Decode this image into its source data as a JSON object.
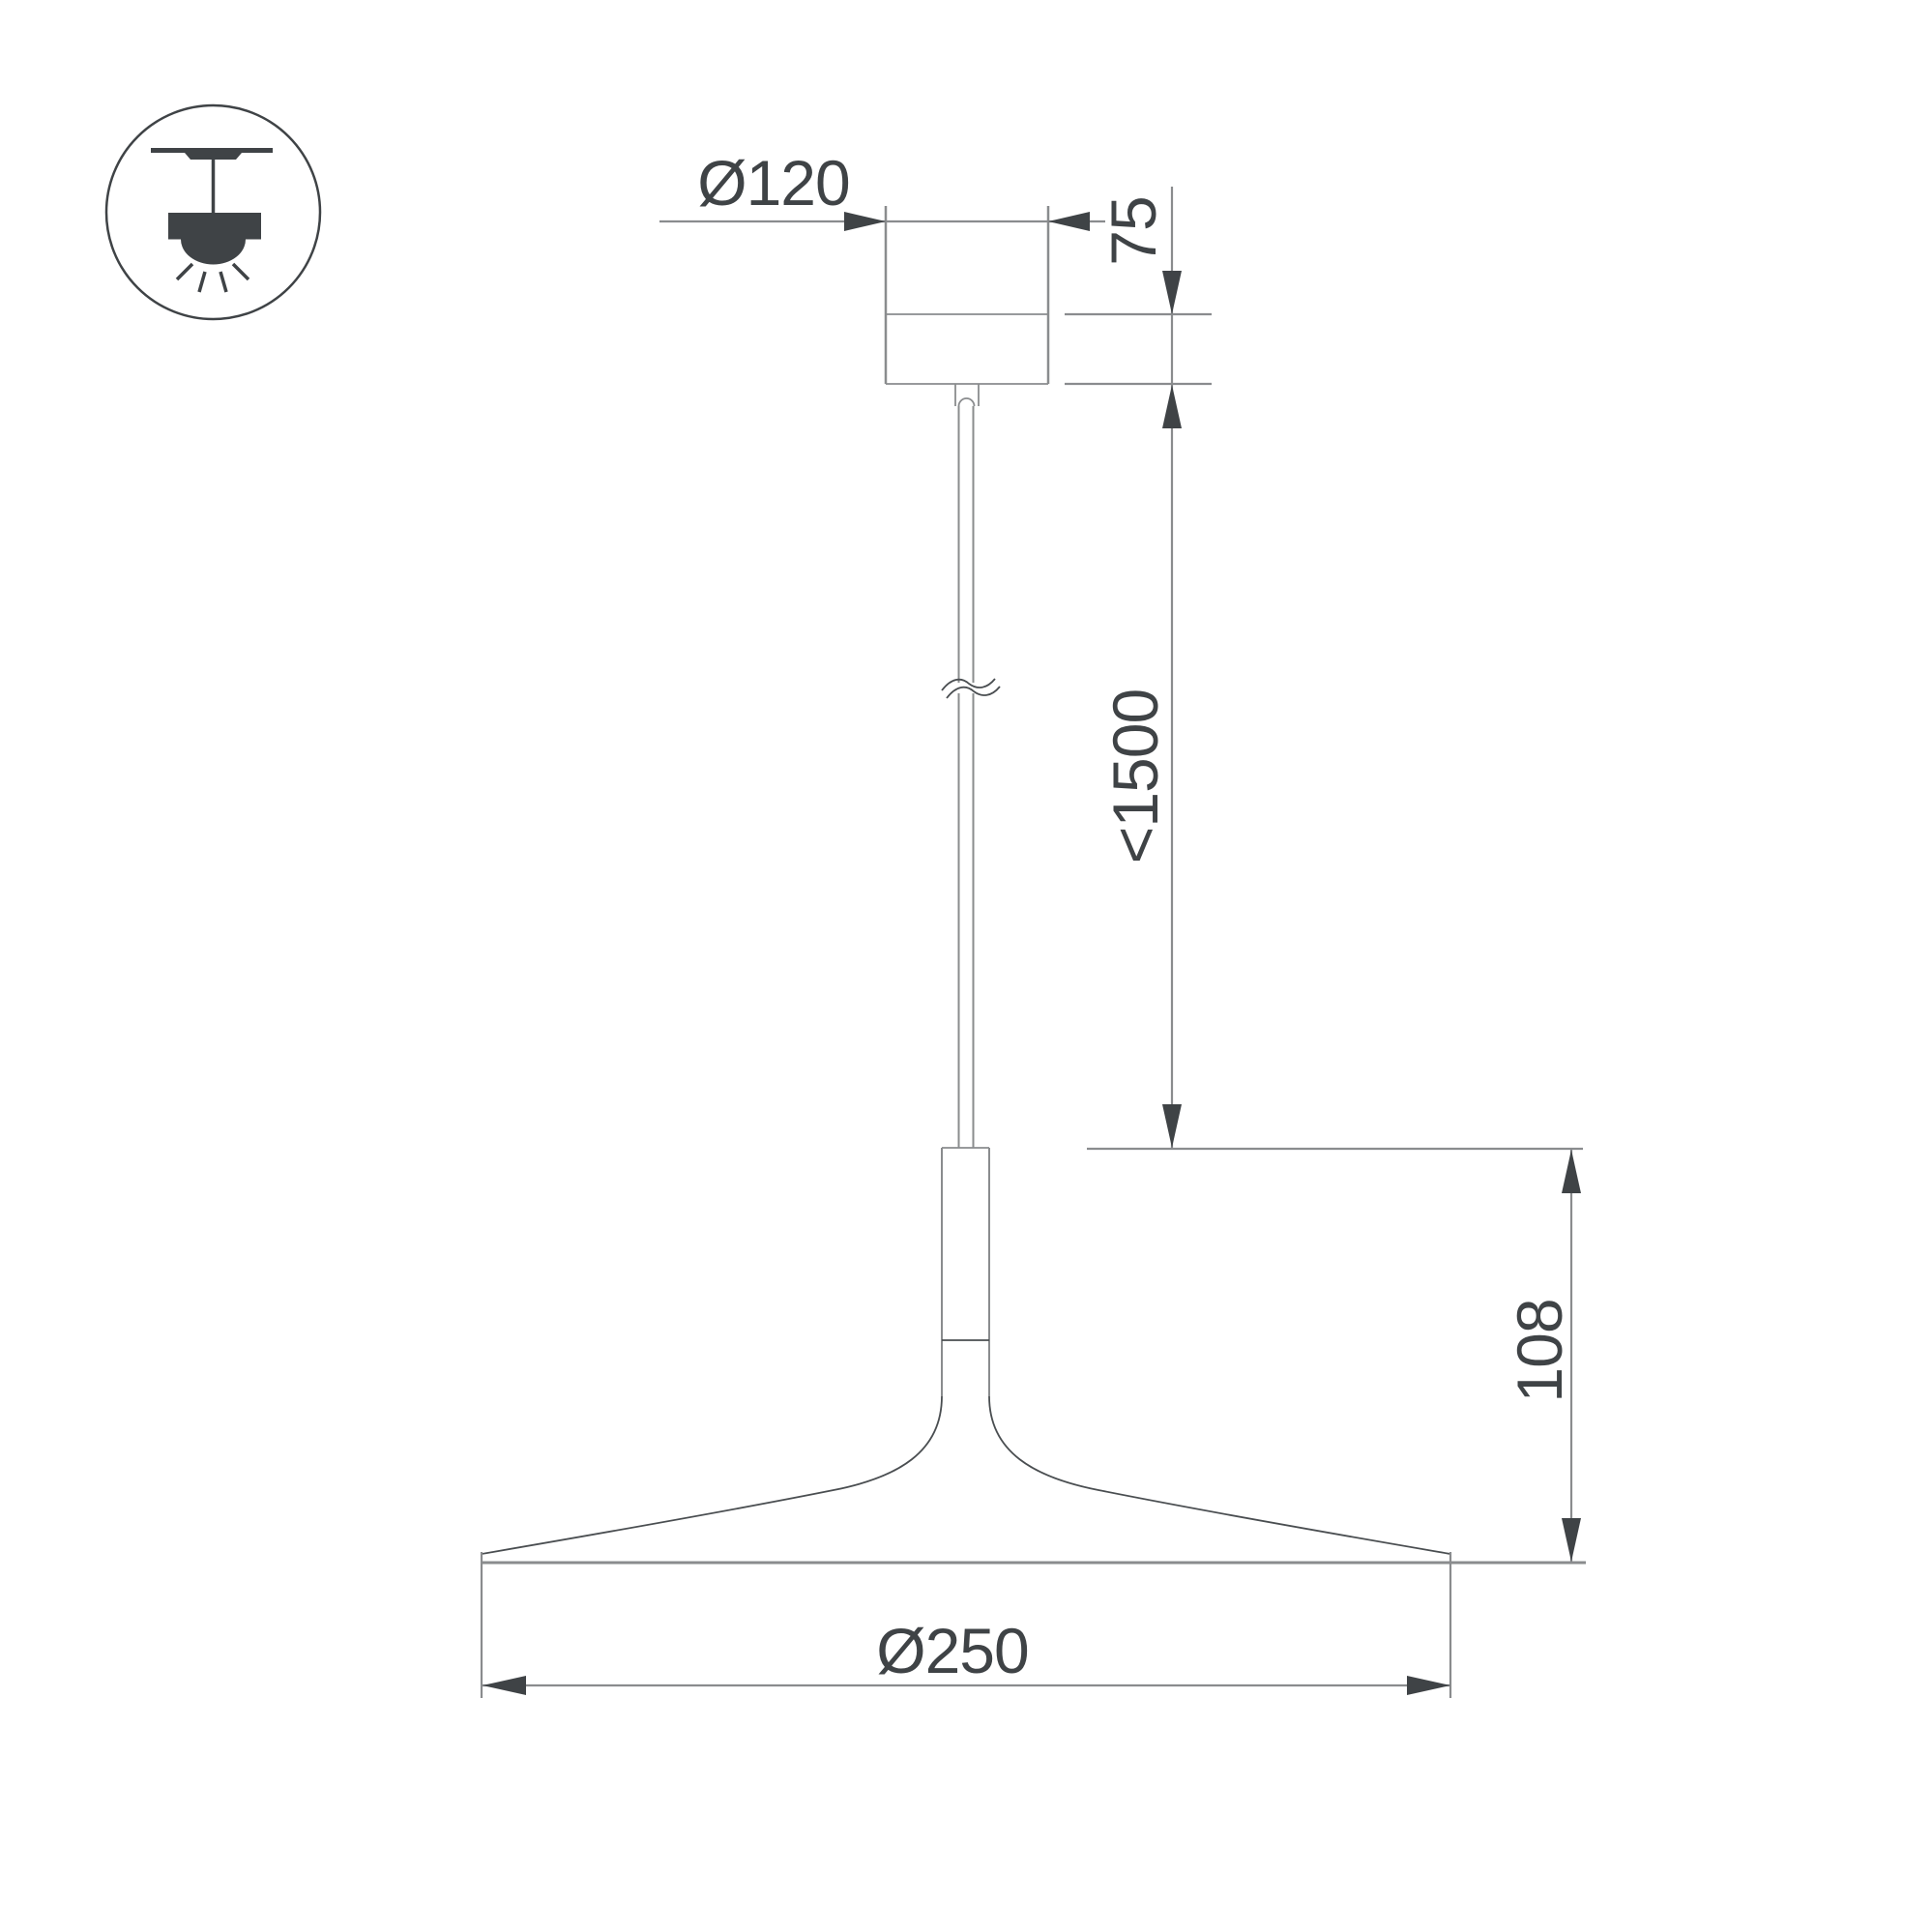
{
  "drawing": {
    "type": "pendant-lamp-dimension-drawing",
    "labels": {
      "canopy_diameter": "Ø120",
      "canopy_height": "75",
      "suspension_length": "<1500",
      "shade_height": "108",
      "shade_diameter": "Ø250"
    },
    "icon": {
      "name": "pendant-ceiling-mount-icon",
      "description": "circled pictogram of ceiling-mounted pendant lamp with downward light rays"
    },
    "colors": {
      "background": "#ffffff",
      "object_line": "#8a8c8e",
      "mid_line": "#97999b",
      "dark": "#3f4346",
      "thin_dark": "#4a4e51"
    }
  }
}
